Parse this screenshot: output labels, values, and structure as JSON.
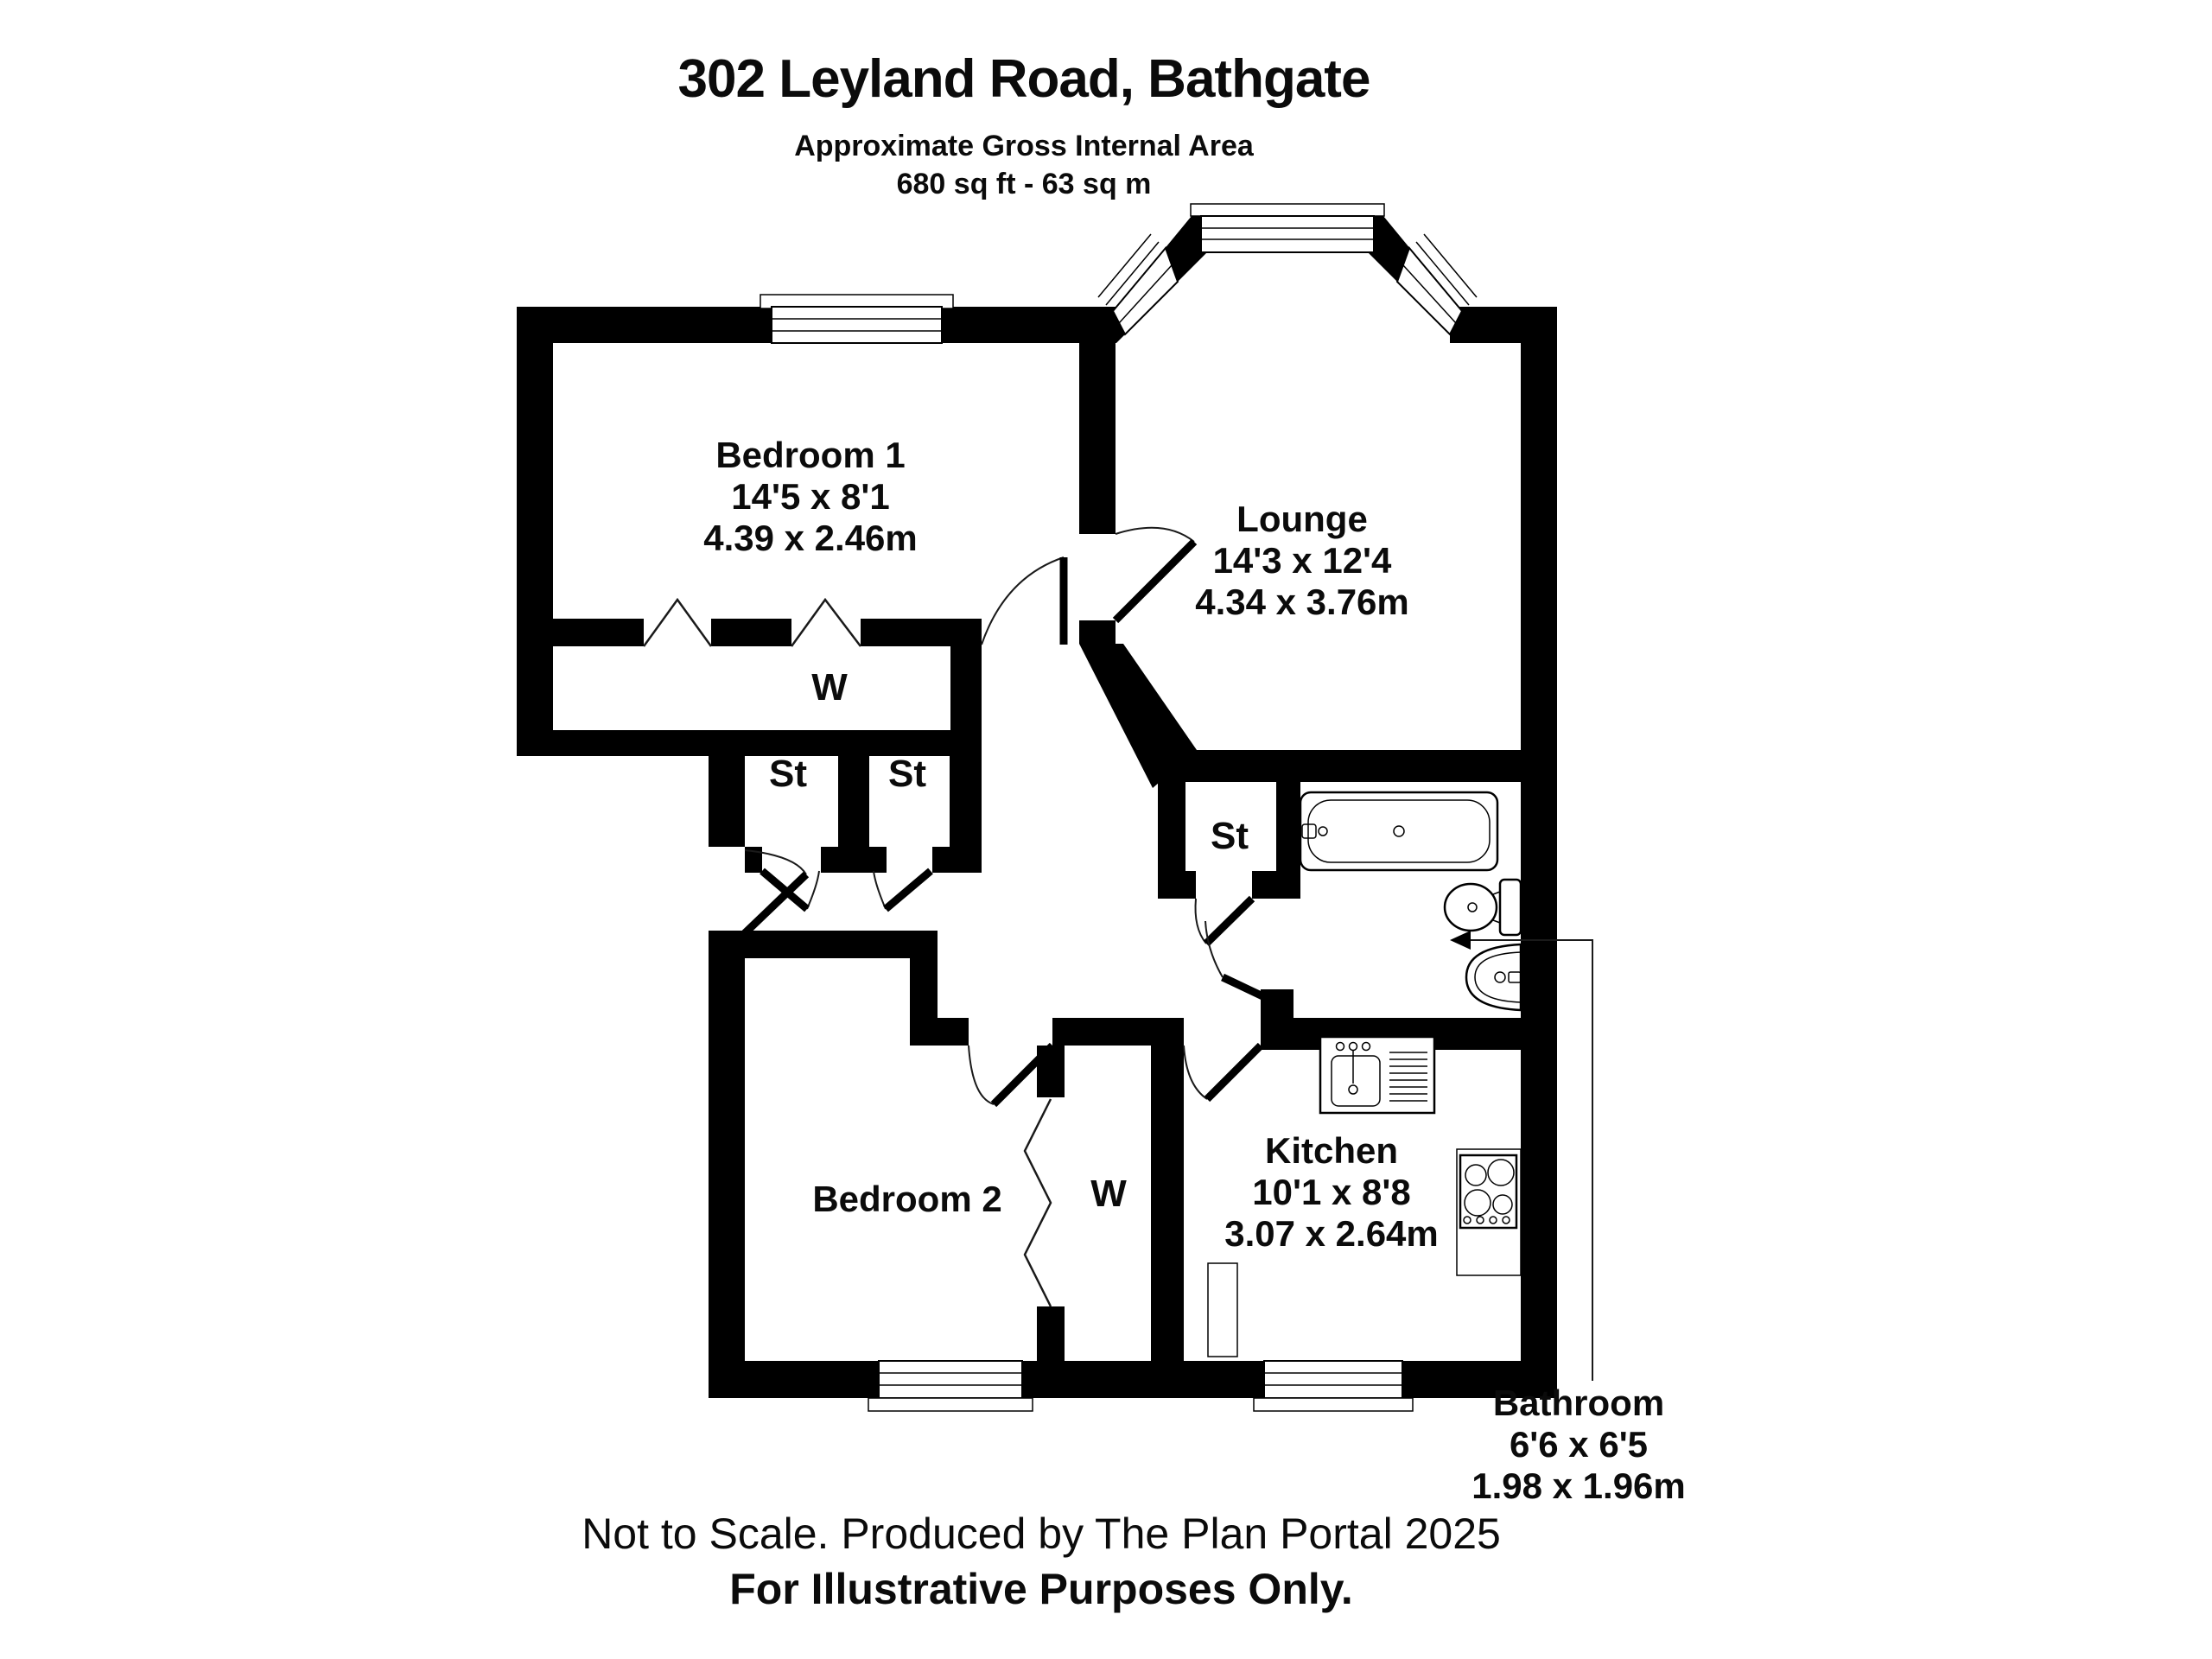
{
  "header": {
    "title": "302 Leyland Road, Bathgate",
    "subtitle": "Approximate Gross Internal Area",
    "area": "680 sq ft - 63 sq m"
  },
  "rooms": {
    "bedroom1": {
      "name": "Bedroom 1",
      "imperial": "14'5 x 8'1",
      "metric": "4.39 x 2.46m"
    },
    "lounge": {
      "name": "Lounge",
      "imperial": "14'3 x 12'4",
      "metric": "4.34 x 3.76m"
    },
    "bedroom2": {
      "name": "Bedroom 2"
    },
    "kitchen": {
      "name": "Kitchen",
      "imperial": "10'1 x 8'8",
      "metric": "3.07 x 2.64m"
    },
    "bathroom": {
      "name": "Bathroom",
      "imperial": "6'6 x 6'5",
      "metric": "1.98 x 1.96m"
    }
  },
  "labels": {
    "wardrobe": "W",
    "storage": "St"
  },
  "footer": {
    "line1": "Not to Scale. Produced by The Plan Portal 2025",
    "line2": "For Illustrative Purposes Only."
  },
  "colors": {
    "wall": "#000000",
    "background": "#ffffff",
    "line": "#1a1a1a"
  }
}
